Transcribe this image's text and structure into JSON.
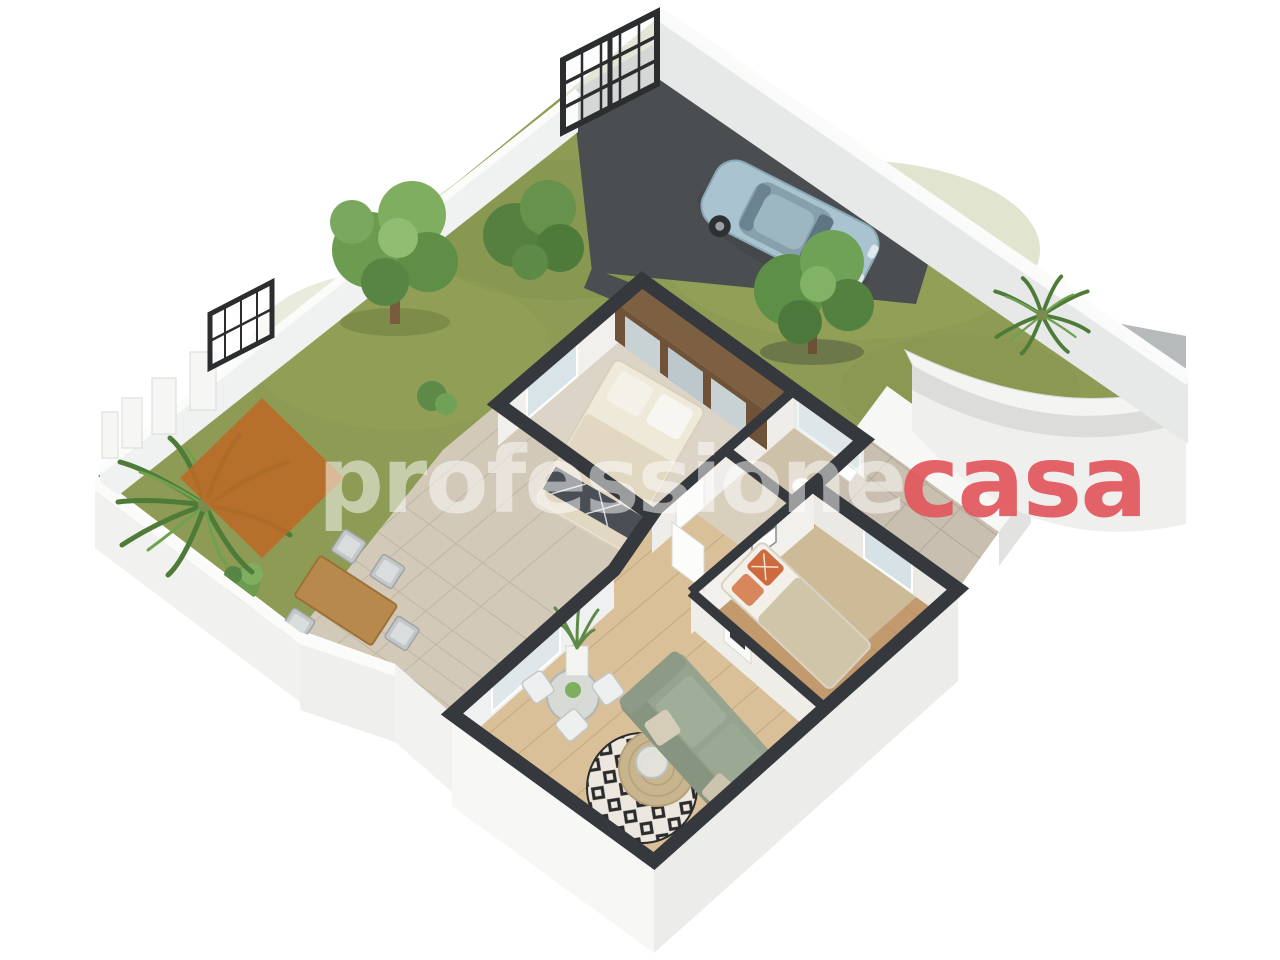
{
  "watermark": {
    "professione": "professione",
    "casa": "casa",
    "professione_color": "#ffffff",
    "casa_color": "#e2575c",
    "diamond_color": "#bd6a27"
  },
  "colors": {
    "background": "#ffffff",
    "grass": "#8d9b54",
    "grass_light": "#9aa85f",
    "grass_dark": "#7c8a48",
    "driveway": "#4b4e50",
    "perimeter_wall_face": "#e7e8e8",
    "perimeter_wall_top": "#fafafa",
    "cut_wall": "#35383c",
    "gate": "#2b2d2f",
    "car_body": "#a9c4d0",
    "car_glass": "#5e7683",
    "terrace_paving": "#d2c9b9",
    "master_floor": "#dcd4c6",
    "bath_floor": "#cdc1a9",
    "bedroom_floor": "#c29a6e",
    "bedroom_rug": "#cdbb97",
    "living_floor": "#d9c098",
    "hall_floor": "#d8cfbd",
    "sofa": "#96a38e",
    "wardrobe_wood": "#7d5f41",
    "tree_green": "#6d9c50",
    "palm_green": "#4e7c38",
    "outdoor_table_wood": "#b8894d",
    "pavers_path": "#c8bfb0"
  }
}
